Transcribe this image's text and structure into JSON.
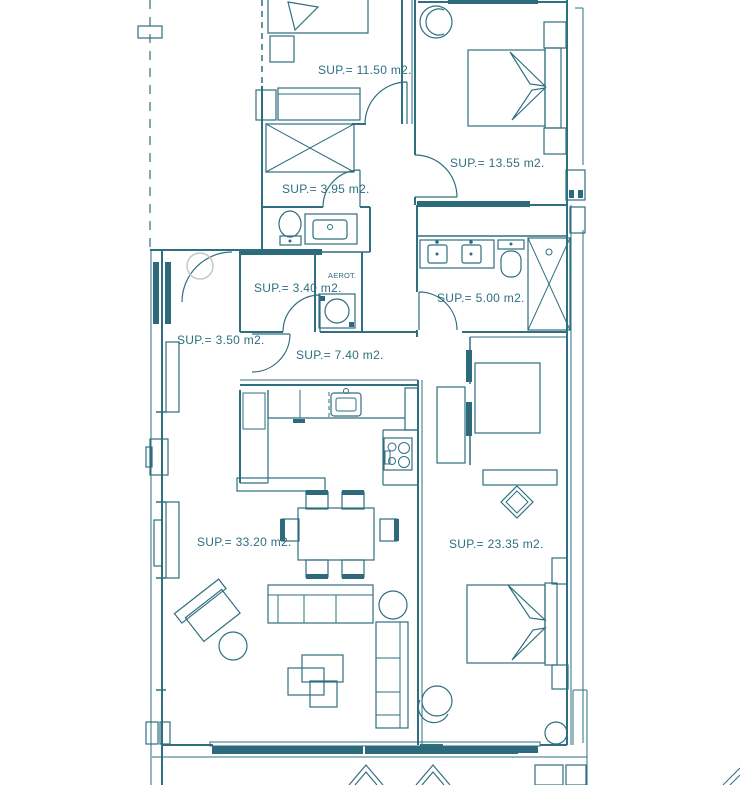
{
  "meta": {
    "type": "architectural-floor-plan"
  },
  "colors": {
    "line": "#2f6f80",
    "dark": "#2d6b7c",
    "gray": "#c5c8ca",
    "bg": "#ffffff"
  },
  "labels": {
    "bedroom1": "SUP.= 11.50 m2.",
    "bedroom2": "SUP.= 13.55 m2.",
    "distributor": "SUP.= 3.95 m2.",
    "bathroom1": "SUP.= 3.40 m2.",
    "aerot": "AEROT.",
    "bathroom2": "SUP.= 5.00 m2.",
    "entry": "SUP.= 3.50 m2.",
    "hall": "SUP.= 7.40 m2.",
    "living": "SUP.= 33.20 m2.",
    "bedroom3": "SUP.= 23.35 m2."
  }
}
